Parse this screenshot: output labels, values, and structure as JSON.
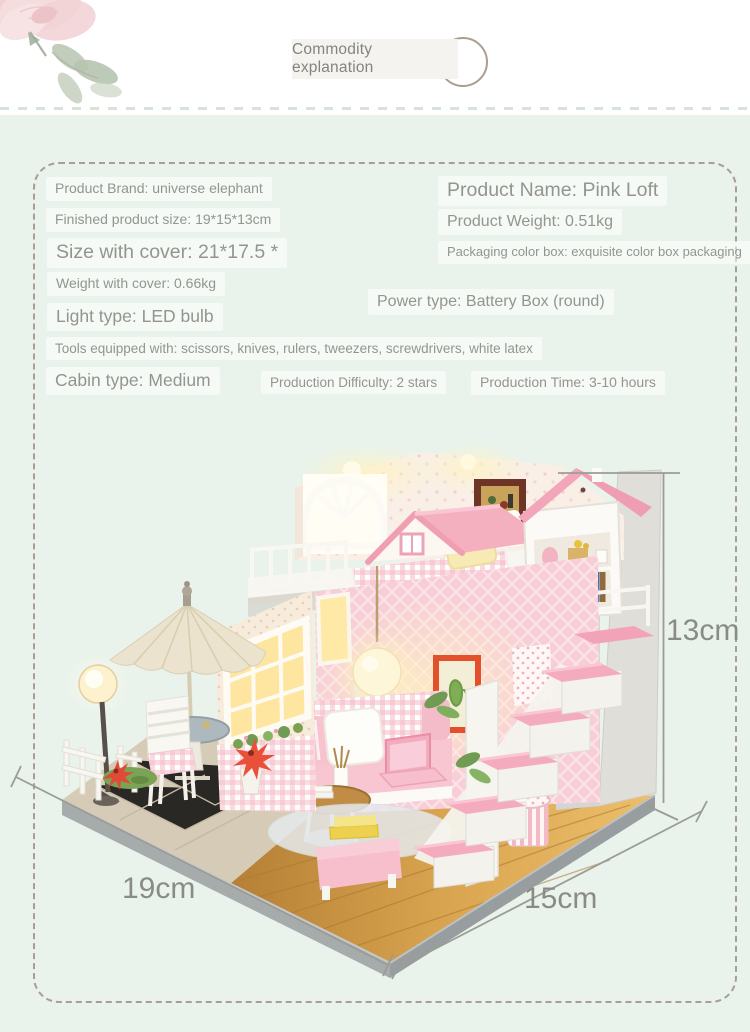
{
  "header": {
    "label": "Commodity explanation"
  },
  "specs": {
    "brand": "Product Brand: universe elephant",
    "finished_size": "Finished product size: 19*15*13cm",
    "size_with_cover": "Size with cover: 21*17.5 *",
    "weight_with_cover": "Weight with cover: 0.66kg",
    "light_type": "Light type: LED bulb",
    "tools": "Tools equipped with: scissors, knives, rulers, tweezers, screwdrivers, white latex",
    "cabin_type": "Cabin type: Medium",
    "difficulty": "Production Difficulty: 2 stars",
    "time": "Production Time: 3-10 hours",
    "name": "Product Name: Pink Loft",
    "weight": "Product Weight: 0.51kg",
    "packaging": "Packaging color box: exquisite color box packaging",
    "power": "Power type: Battery Box (round)"
  },
  "dimensions": {
    "height": "13cm",
    "width": "19cm",
    "depth": "15cm"
  },
  "decorations": {
    "rose_icon": "watercolor-rose",
    "ring_icon": "circle-ring-ornament"
  },
  "colors": {
    "background_mint": "#e9f3ec",
    "dashed_border": "#a89e94",
    "text_gray": "#94958d",
    "dimension_text": "#8a8b85",
    "accent_pink": "#f3aabf",
    "wood": "#c98f3f"
  }
}
